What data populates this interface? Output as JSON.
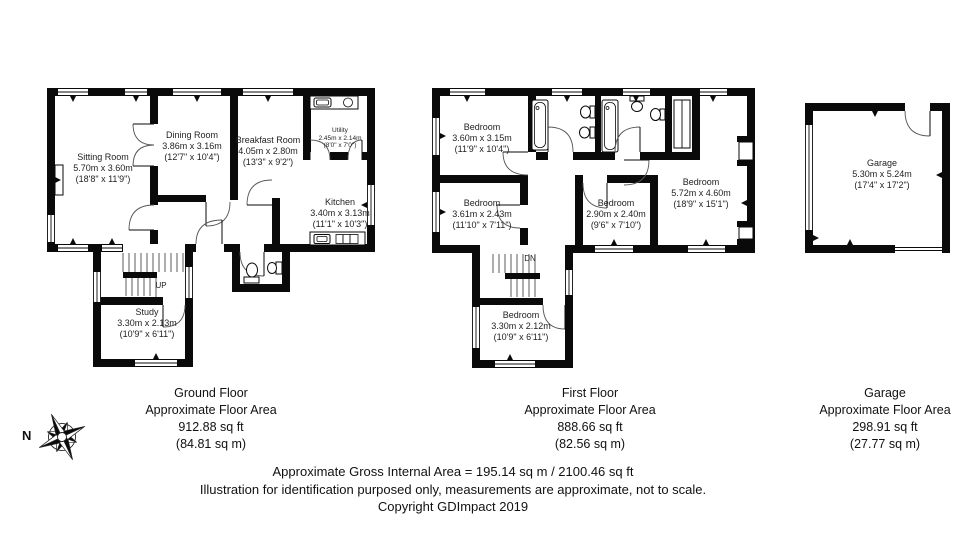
{
  "ground_floor": {
    "caption": {
      "title": "Ground Floor",
      "subtitle": "Approximate Floor Area",
      "area_ft": "912.88 sq ft",
      "area_m": "(84.81 sq m)"
    },
    "stair_label": "UP",
    "rooms": [
      {
        "name": "Sitting Room",
        "metric": "5.70m x 3.60m",
        "imperial": "(18'8\" x 11'9\")"
      },
      {
        "name": "Dining Room",
        "metric": "3.86m x 3.16m",
        "imperial": "(12'7\" x 10'4\")"
      },
      {
        "name": "Breakfast Room",
        "metric": "4.05m x 2.80m",
        "imperial": "(13'3\" x 9'2\")"
      },
      {
        "name": "Utility",
        "metric": "2.45m x 2.14m",
        "imperial": "(8'0\" x 7'0\")"
      },
      {
        "name": "Kitchen",
        "metric": "3.40m x 3.13m",
        "imperial": "(11'1\" x 10'3\")"
      },
      {
        "name": "Study",
        "metric": "3.30m x 2.13m",
        "imperial": "(10'9\" x 6'11\")"
      }
    ]
  },
  "first_floor": {
    "caption": {
      "title": "First Floor",
      "subtitle": "Approximate Floor Area",
      "area_ft": "888.66 sq ft",
      "area_m": "(82.56 sq m)"
    },
    "stair_label": "DN",
    "rooms": [
      {
        "name": "Bedroom",
        "metric": "3.60m x 3.15m",
        "imperial": "(11'9\" x 10'4\")"
      },
      {
        "name": "Bedroom",
        "metric": "3.61m x 2.43m",
        "imperial": "(11'10\" x 7'11\")"
      },
      {
        "name": "Bedroom",
        "metric": "2.90m x 2.40m",
        "imperial": "(9'6\" x 7'10\")"
      },
      {
        "name": "Bedroom",
        "metric": "5.72m x 4.60m",
        "imperial": "(18'9\" x 15'1\")"
      },
      {
        "name": "Bedroom",
        "metric": "3.30m x 2.12m",
        "imperial": "(10'9\" x 6'11\")"
      }
    ]
  },
  "garage": {
    "caption": {
      "title": "Garage",
      "subtitle": "Approximate Floor Area",
      "area_ft": "298.91 sq ft",
      "area_m": "(27.77 sq m)"
    },
    "rooms": [
      {
        "name": "Garage",
        "metric": "5.30m x 5.24m",
        "imperial": "(17'4\" x 17'2\")"
      }
    ]
  },
  "footer": {
    "line1": "Approximate Gross Internal Area = 195.14 sq m / 2100.46 sq ft",
    "line2": "Illustration for identification purposed only, measurements are approximate, not to scale.",
    "line3": "Copyright GDImpact 2019"
  },
  "compass": {
    "label": "N"
  },
  "colors": {
    "wall": "#0a0a0a",
    "background": "#ffffff",
    "text": "#1f1f1f",
    "thin_line": "#555555"
  }
}
